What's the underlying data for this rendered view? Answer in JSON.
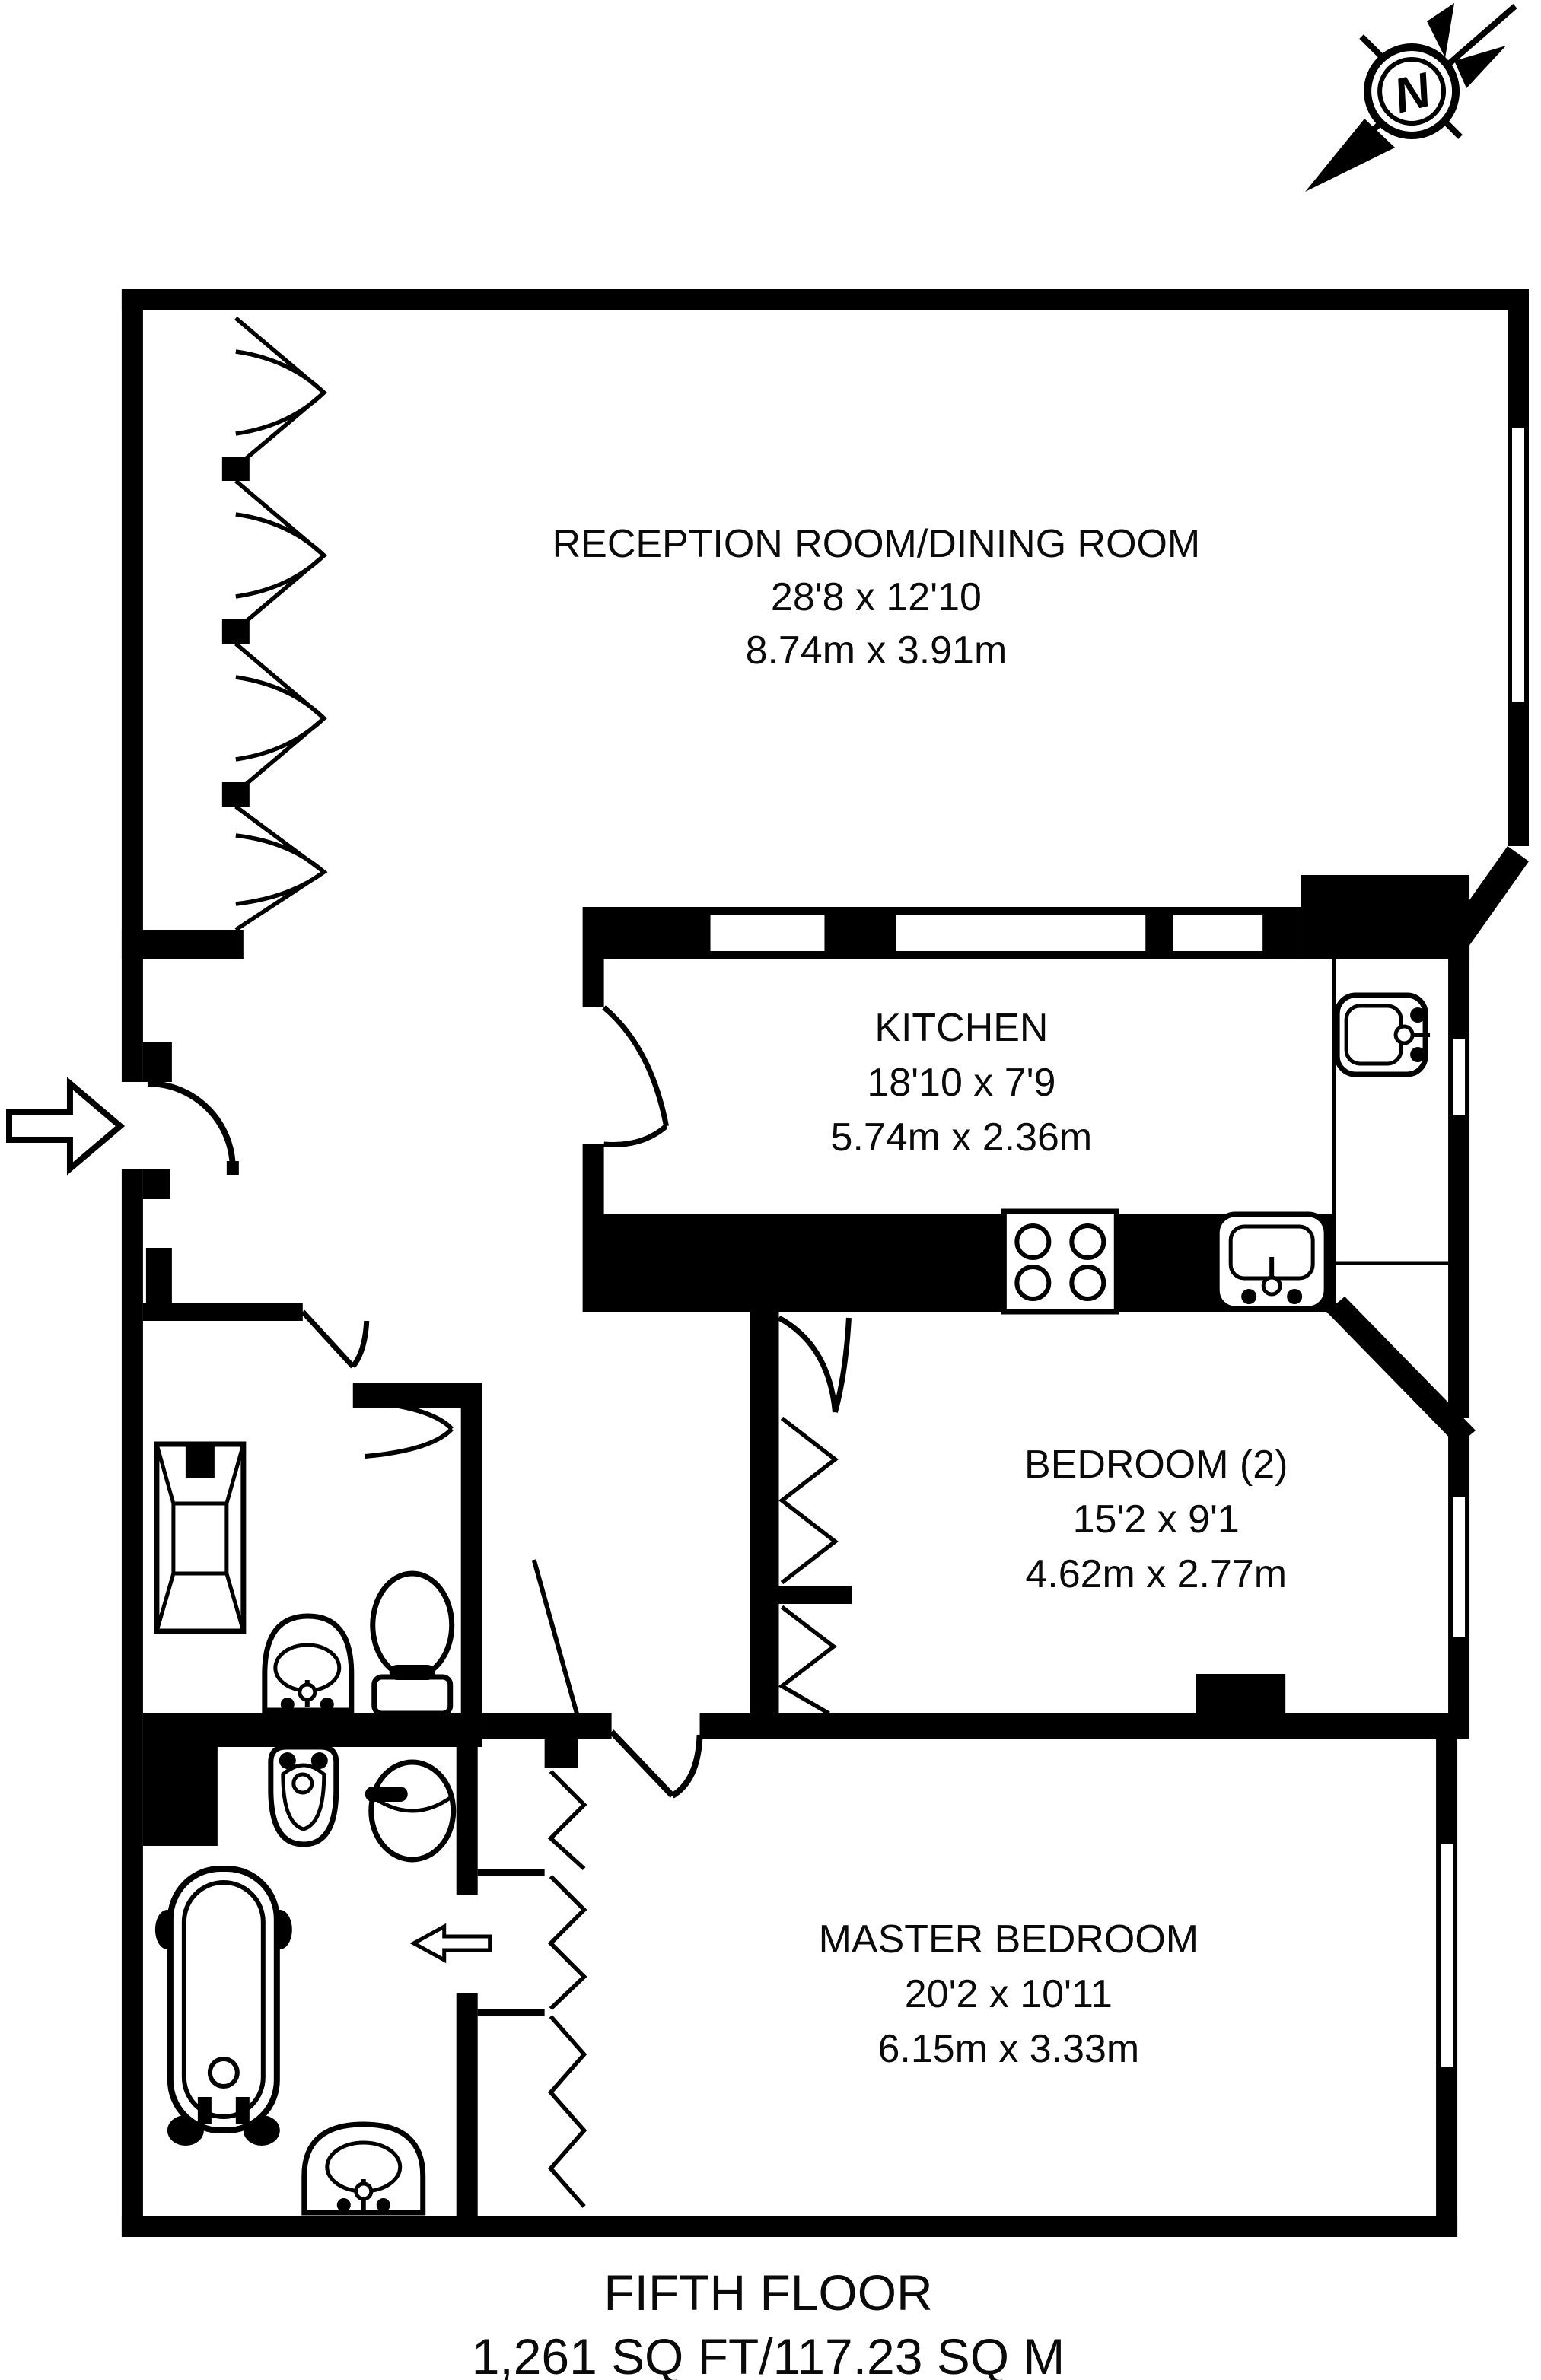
{
  "compass": {
    "label": "N"
  },
  "rooms": {
    "reception": {
      "name": "RECEPTION ROOM/DINING ROOM",
      "imperial": "28'8 x 12'10",
      "metric": "8.74m x 3.91m"
    },
    "kitchen": {
      "name": "KITCHEN",
      "imperial": "18'10 x 7'9",
      "metric": "5.74m x 2.36m"
    },
    "bedroom2": {
      "name": "BEDROOM (2)",
      "imperial": "15'2 x 9'1",
      "metric": "4.62m x 2.77m"
    },
    "master": {
      "name": "MASTER BEDROOM",
      "imperial": "20'2 x 10'11",
      "metric": "6.15m x 3.33m"
    }
  },
  "footer": {
    "floor": "FIFTH FLOOR",
    "area": "1,261 SQ FT/117.23 SQ M"
  },
  "colors": {
    "wall": "#000000",
    "background": "#ffffff"
  }
}
